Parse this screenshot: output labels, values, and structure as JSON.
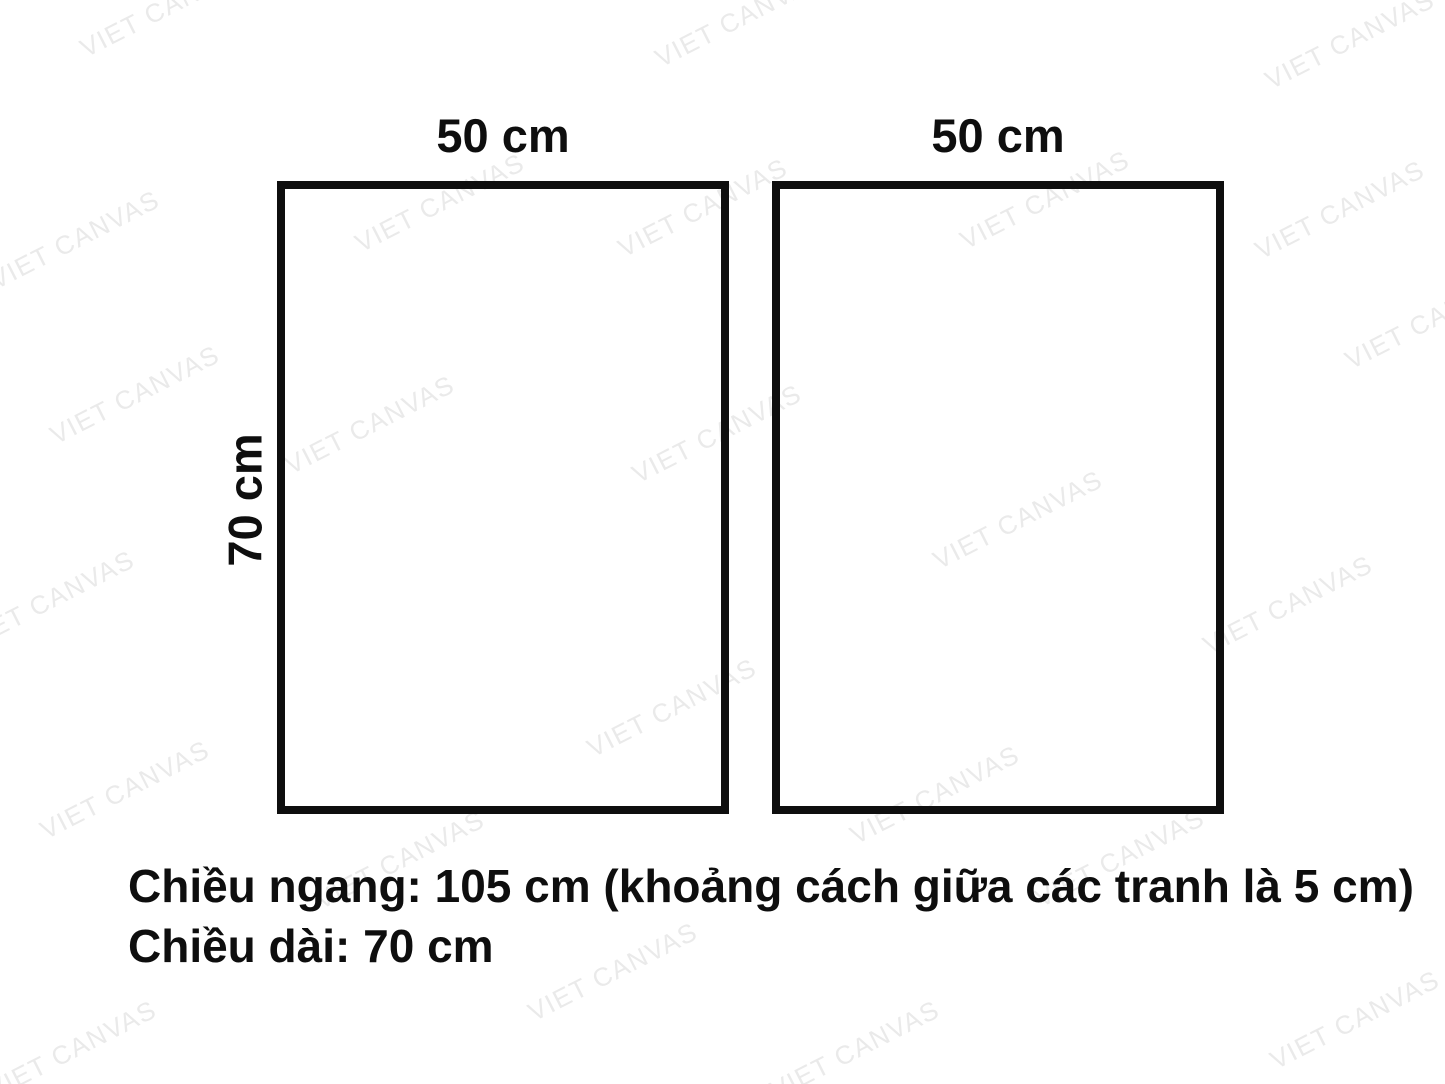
{
  "watermark": {
    "text": "VIET CANVAS",
    "color": "#eaeaea"
  },
  "diagram": {
    "ink_color": "#0e0e0e",
    "panels": [
      {
        "width_label": "50 cm"
      },
      {
        "width_label": "50 cm"
      }
    ],
    "height_label": "70 cm",
    "notes": {
      "line1": "Chiều ngang: 105 cm (khoảng cách giữa các tranh là 5 cm)",
      "line2": "Chiều dài: 70 cm"
    }
  }
}
